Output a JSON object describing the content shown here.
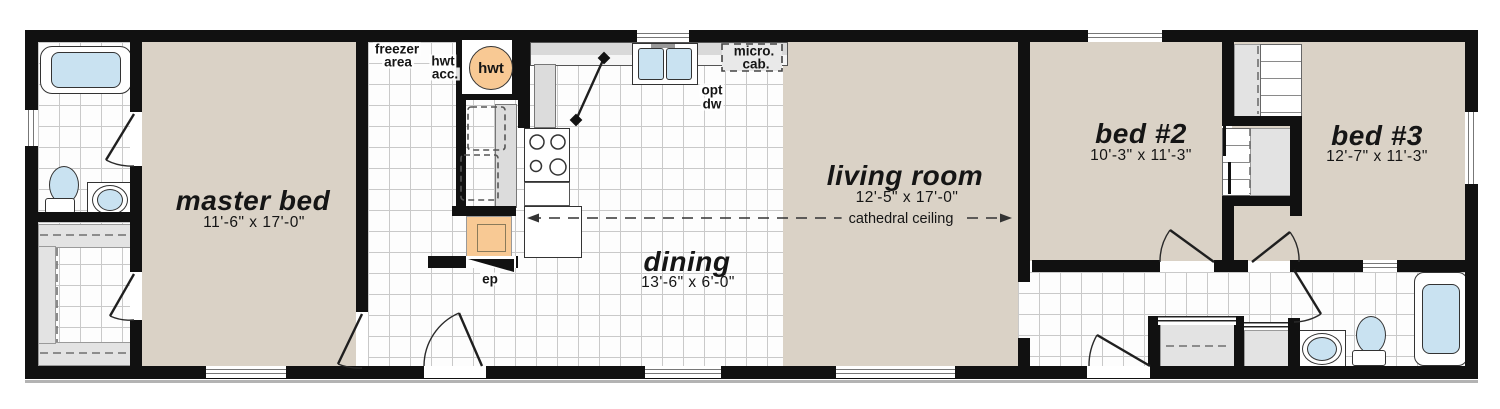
{
  "colors": {
    "wall": "#111111",
    "floor_tan": "#dad2c6",
    "water_blue": "#c9e2f1",
    "fixture_orange": "#f8c994",
    "counter_gray": "#dcdcdc"
  },
  "rooms": {
    "master": {
      "name": "master bed",
      "dims": "11'-6\" x 17'-0\""
    },
    "dining": {
      "name": "dining",
      "dims": "13'-6\" x 6'-0\""
    },
    "living": {
      "name": "living room",
      "dims": "12'-5\" x 17'-0\"",
      "note": "cathedral ceiling"
    },
    "bed2": {
      "name": "bed #2",
      "dims": "10'-3\" x 11'-3\""
    },
    "bed3": {
      "name": "bed #3",
      "dims": "12'-7\" x 11'-3\""
    }
  },
  "labels": {
    "freezer_line1": "freezer",
    "freezer_line2": "area",
    "hwt_acc_line1": "hwt",
    "hwt_acc_line2": "acc.",
    "hwt_tank": "hwt",
    "micro_line1": "micro.",
    "micro_line2": "cab.",
    "optdw_line1": "opt",
    "optdw_line2": "dw",
    "ep": "ep"
  }
}
